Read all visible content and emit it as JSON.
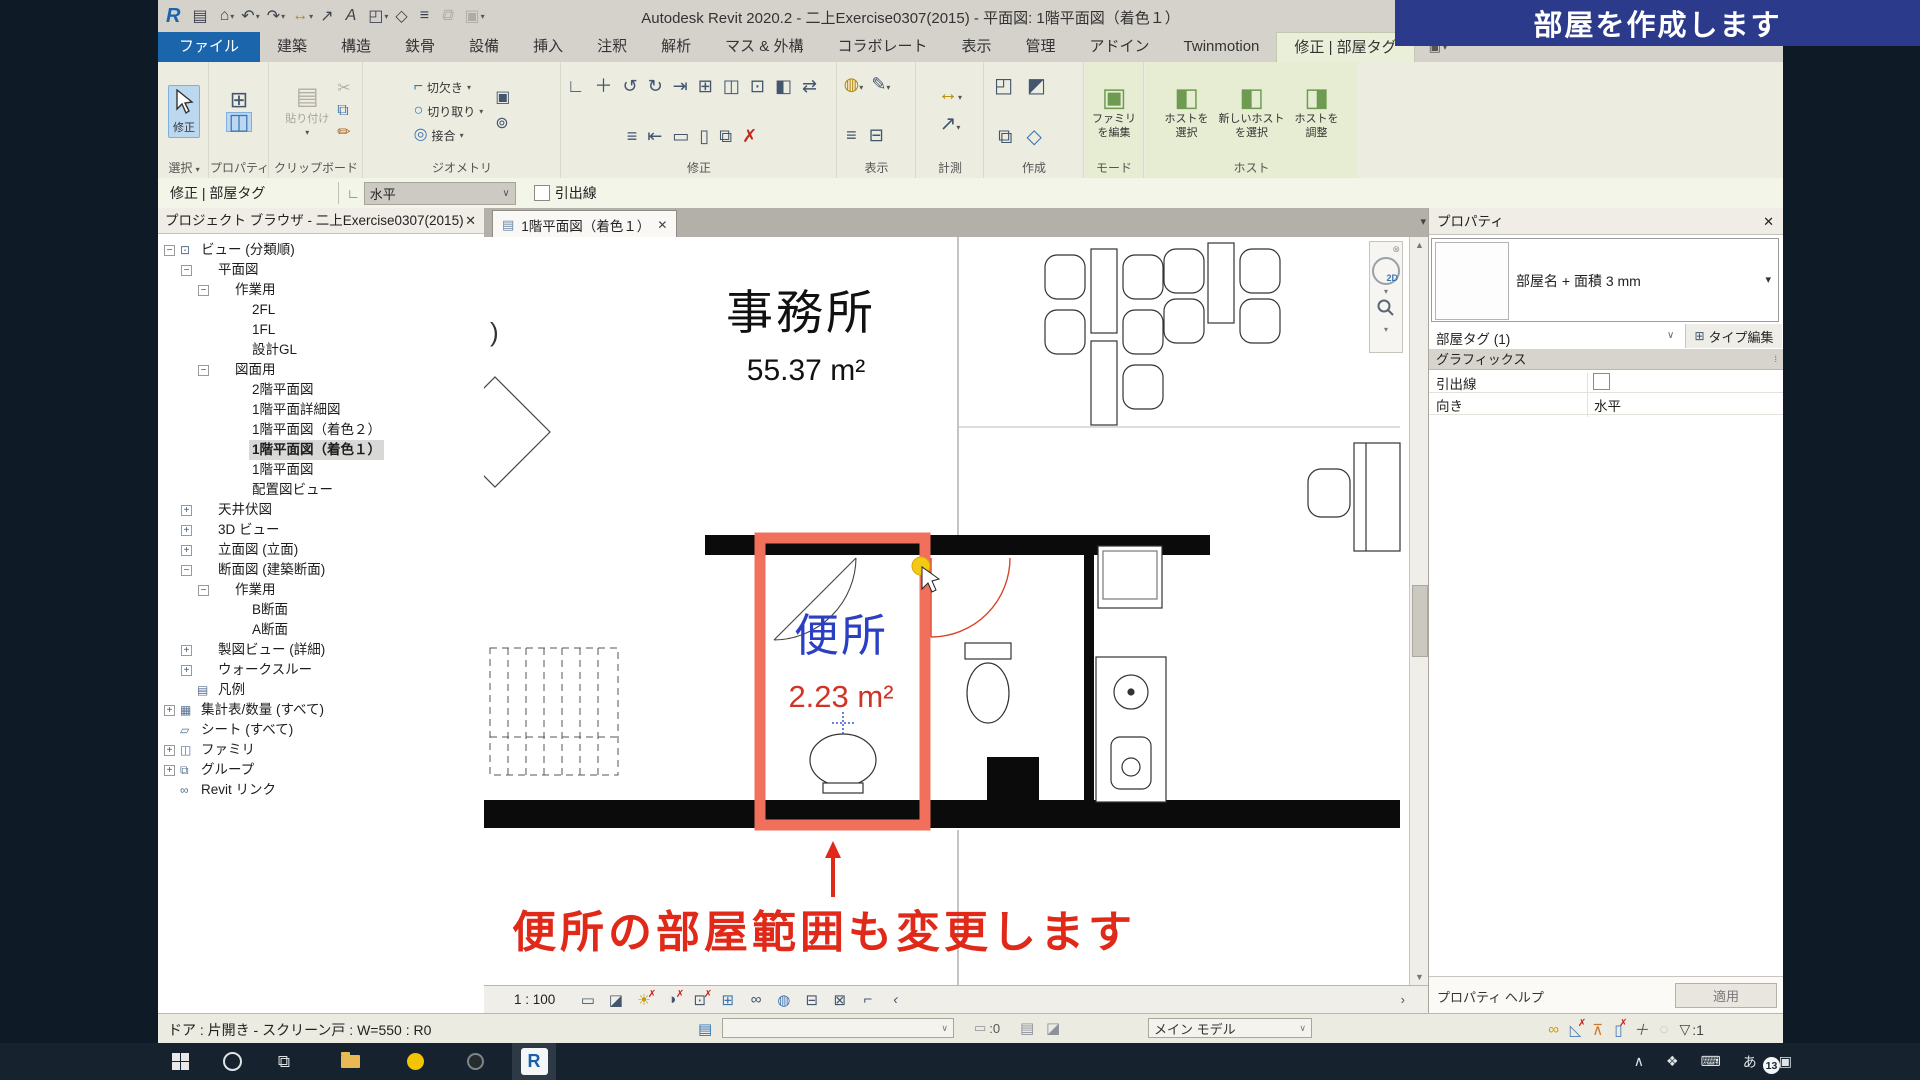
{
  "titlebar": {
    "title": "Autodesk Revit 2020.2 - 二上Exercise0307(2015) - 平面図: 1階平面図（着色１）"
  },
  "banner": {
    "text": "部屋を作成します"
  },
  "icons": {
    "close": "✕",
    "caret_down": "▾",
    "chevron_down": "∨",
    "collapse": "◂",
    "binoculars": "⊙⊙",
    "ribbon_panel_btn": "▣",
    "options_orient": "∟",
    "view_tab_file": "▤",
    "nav_close": "⊗",
    "nav_2d": "2D",
    "scroll_up": "▲",
    "scroll_down": "▼",
    "scroll_right": "›",
    "edit_type_icon": "⊞",
    "section_pin": "⁞",
    "workset_icon": "▤",
    "editable_icon": "▭",
    "sb_icon1": "▤",
    "sb_icon2": "◪",
    "funnel": "▽",
    "qat": [
      {
        "g": "R",
        "c": "r",
        "n": "revit-logo"
      },
      {
        "g": "▤",
        "n": "open-icon"
      },
      {
        "g": "⌂",
        "dd": 1,
        "n": "home-icon"
      },
      {
        "g": "↶",
        "dd": 1,
        "n": "undo-icon"
      },
      {
        "g": "↷",
        "dd": 1,
        "n": "redo-icon"
      },
      {
        "g": "↔",
        "c": "y",
        "dd": 1,
        "n": "dimension-icon"
      },
      {
        "g": "↗",
        "n": "detail-line-icon"
      },
      {
        "g": "A",
        "n": "text-icon"
      },
      {
        "g": "◰",
        "dd": 1,
        "n": "3d-view-icon"
      },
      {
        "g": "◇",
        "n": "section-icon"
      },
      {
        "g": "≡",
        "n": "thin-lines-icon"
      },
      {
        "g": "⧉",
        "c": "dis",
        "n": "switch-windows-icon"
      },
      {
        "g": "▣",
        "dd": 1,
        "c": "dis",
        "n": "close-hidden-icon"
      }
    ],
    "tray": [
      {
        "g": "∧",
        "n": "tray-expand-icon"
      },
      {
        "g": "❖",
        "n": "dropbox-icon"
      },
      {
        "g": "⌨",
        "n": "keyboard-icon"
      },
      {
        "g": "あ",
        "n": "ime-icon"
      },
      {
        "g": "▣",
        "n": "action-center-icon"
      }
    ]
  },
  "tabs": [
    {
      "label": "ファイル",
      "file": true
    },
    {
      "label": "建築"
    },
    {
      "label": "構造"
    },
    {
      "label": "鉄骨"
    },
    {
      "label": "設備"
    },
    {
      "label": "挿入"
    },
    {
      "label": "注釈"
    },
    {
      "label": "解析"
    },
    {
      "label": "マス & 外構"
    },
    {
      "label": "コラボレート"
    },
    {
      "label": "表示"
    },
    {
      "label": "管理"
    },
    {
      "label": "アドイン"
    },
    {
      "label": "Twinmotion"
    },
    {
      "label": "修正 | 部屋タグ",
      "active": true
    }
  ],
  "ribbon": {
    "select": {
      "label": "選択",
      "caret": "▾",
      "modify": "修正"
    },
    "properties": {
      "label": "プロパティ"
    },
    "clipboard": {
      "label": "クリップボード",
      "paste": "貼り付け",
      "side": [
        {
          "g": "✂",
          "c": "dis"
        },
        {
          "g": "⧉",
          "c": "b"
        },
        {
          "g": "✏",
          "c": "o"
        }
      ]
    },
    "geometry": {
      "label": "ジオメトリ",
      "rows": [
        {
          "g": "⌐",
          "label": "切欠き"
        },
        {
          "g": "○",
          "label": "切り取り"
        },
        {
          "g": "◎",
          "label": "接合"
        }
      ],
      "side": [
        {
          "g": "▣"
        },
        {
          "g": "⊚"
        }
      ]
    },
    "modify": {
      "label": "修正",
      "icons": [
        {
          "g": "∟"
        },
        {
          "g": "＋"
        },
        {
          "g": "↺"
        },
        {
          "g": "↻"
        },
        {
          "g": "⇥"
        },
        {
          "g": "⊞"
        },
        {
          "g": "◫"
        },
        {
          "g": "⊡"
        },
        {
          "g": "◧"
        },
        {
          "g": "⇄"
        },
        {
          "g": "≡"
        },
        {
          "g": "⇤"
        },
        {
          "g": "▭"
        },
        {
          "g": "▯"
        },
        {
          "g": "⧉"
        },
        {
          "g": "✗",
          "c": "red"
        }
      ]
    },
    "view": {
      "label": "表示",
      "icons": [
        {
          "g": "◍",
          "c": "y",
          "dd": 1
        },
        {
          "g": "✎",
          "dd": 1
        },
        {
          "g": "≡"
        },
        {
          "g": "⊟"
        }
      ]
    },
    "measure": {
      "label": "計測",
      "icons": [
        {
          "g": "↔",
          "c": "y",
          "dd": 1
        },
        {
          "g": "↗",
          "dd": 1
        }
      ]
    },
    "create": {
      "label": "作成",
      "icons": [
        {
          "g": "◰"
        },
        {
          "g": "◩"
        },
        {
          "g": "⧉"
        },
        {
          "g": "◇",
          "c": "b"
        }
      ]
    },
    "mode": {
      "label": "モード",
      "edit_family": {
        "icon": "▣",
        "l1": "ファミリ",
        "l2": "を編集"
      }
    },
    "host": {
      "label": "ホスト",
      "buttons": [
        {
          "icon": "◧",
          "l1": "ホストを",
          "l2": "選択"
        },
        {
          "icon": "◧",
          "l1": "新しいホスト",
          "l2": "を選択"
        },
        {
          "icon": "◨",
          "l1": "ホストを",
          "l2": "調整"
        }
      ]
    }
  },
  "options_bar": {
    "context": "修正 | 部屋タグ",
    "orientation": "水平",
    "leader_label": "引出線"
  },
  "project_browser": {
    "title": "プロジェクト ブラウザ - 二上Exercise0307(2015)",
    "items": [
      {
        "label": "ビュー (分類順)",
        "d": 0,
        "g": "−",
        "icg": "⊡"
      },
      {
        "label": "平面図",
        "d": 1,
        "g": "−"
      },
      {
        "label": "作業用",
        "d": 2,
        "g": "−"
      },
      {
        "label": "2FL",
        "d": 3
      },
      {
        "label": "1FL",
        "d": 3
      },
      {
        "label": "設計GL",
        "d": 3
      },
      {
        "label": "図面用",
        "d": 2,
        "g": "−"
      },
      {
        "label": "2階平面図",
        "d": 3
      },
      {
        "label": "1階平面詳細図",
        "d": 3
      },
      {
        "label": "1階平面図（着色２）",
        "d": 3
      },
      {
        "label": "1階平面図（着色１）",
        "d": 3,
        "sel": true
      },
      {
        "label": "1階平面図",
        "d": 3
      },
      {
        "label": "配置図ビュー",
        "d": 3
      },
      {
        "label": "天井伏図",
        "d": 1,
        "g": "+"
      },
      {
        "label": "3D ビュー",
        "d": 1,
        "g": "+"
      },
      {
        "label": "立面図 (立面)",
        "d": 1,
        "g": "+"
      },
      {
        "label": "断面図 (建築断面)",
        "d": 1,
        "g": "−"
      },
      {
        "label": "作業用",
        "d": 2,
        "g": "−"
      },
      {
        "label": "B断面",
        "d": 3
      },
      {
        "label": "A断面",
        "d": 3
      },
      {
        "label": "製図ビュー (詳細)",
        "d": 1,
        "g": "+"
      },
      {
        "label": "ウォークスルー",
        "d": 1,
        "g": "+"
      },
      {
        "label": "凡例",
        "d": 1,
        "icg": "▤"
      },
      {
        "label": "集計表/数量 (すべて)",
        "d": 0,
        "g": "+",
        "icg": "▦"
      },
      {
        "label": "シート (すべて)",
        "d": 0,
        "icg": "▱"
      },
      {
        "label": "ファミリ",
        "d": 0,
        "g": "+",
        "icg": "◫"
      },
      {
        "label": "グループ",
        "d": 0,
        "g": "+",
        "icg": "⧉"
      },
      {
        "label": "Revit リンク",
        "d": 0,
        "icg": "∞"
      }
    ]
  },
  "canvas": {
    "view_tab": "1階平面図（着色１）",
    "scale": "1 : 100",
    "grid_bubble": ")",
    "rooms": [
      {
        "name": "事務所",
        "area": "55.37 m²"
      },
      {
        "name": "便所",
        "area": "2.23 m²"
      }
    ],
    "annotation": "便所の部屋範囲も変更します",
    "viewbar_icons": [
      {
        "g": "▭"
      },
      {
        "g": "◪"
      },
      {
        "g": "☀",
        "x": 1,
        "c": "y"
      },
      {
        "g": "◑",
        "x": 1
      },
      {
        "g": "⊡",
        "x": 1
      },
      {
        "g": "⊞",
        "c": "b"
      },
      {
        "g": "∞"
      },
      {
        "g": "◍",
        "c": "b"
      },
      {
        "g": "⊟"
      },
      {
        "g": "⊠"
      },
      {
        "g": "⌐"
      },
      {
        "g": "‹"
      }
    ]
  },
  "properties_panel": {
    "title": "プロパティ",
    "type_selector": "部屋名 + 面積 3 mm",
    "element_filter": "部屋タグ (1)",
    "edit_type": "タイプ編集",
    "section_graphics": "グラフィックス",
    "rows": [
      {
        "label": "引出線",
        "value": "",
        "checkbox": true
      },
      {
        "label": "向き",
        "value": "水平"
      }
    ],
    "help": "プロパティ ヘルプ",
    "apply": "適用"
  },
  "status_bar": {
    "message": "ドア : 片開き - スクリーン戸 : W=550 : R0",
    "editable_count": ":0",
    "main_model": "メイン モデル",
    "filter_count": ":1",
    "right_icons": [
      {
        "g": "∞",
        "c": "gold"
      },
      {
        "g": "◺",
        "c": "b",
        "x": 1
      },
      {
        "g": "⊼",
        "c": "o"
      },
      {
        "g": "▯",
        "c": "b",
        "x": 1
      },
      {
        "g": "＋",
        "c": "gr"
      },
      {
        "g": "◌",
        "c": "dim"
      }
    ]
  },
  "taskbar": {
    "badge": "13"
  }
}
